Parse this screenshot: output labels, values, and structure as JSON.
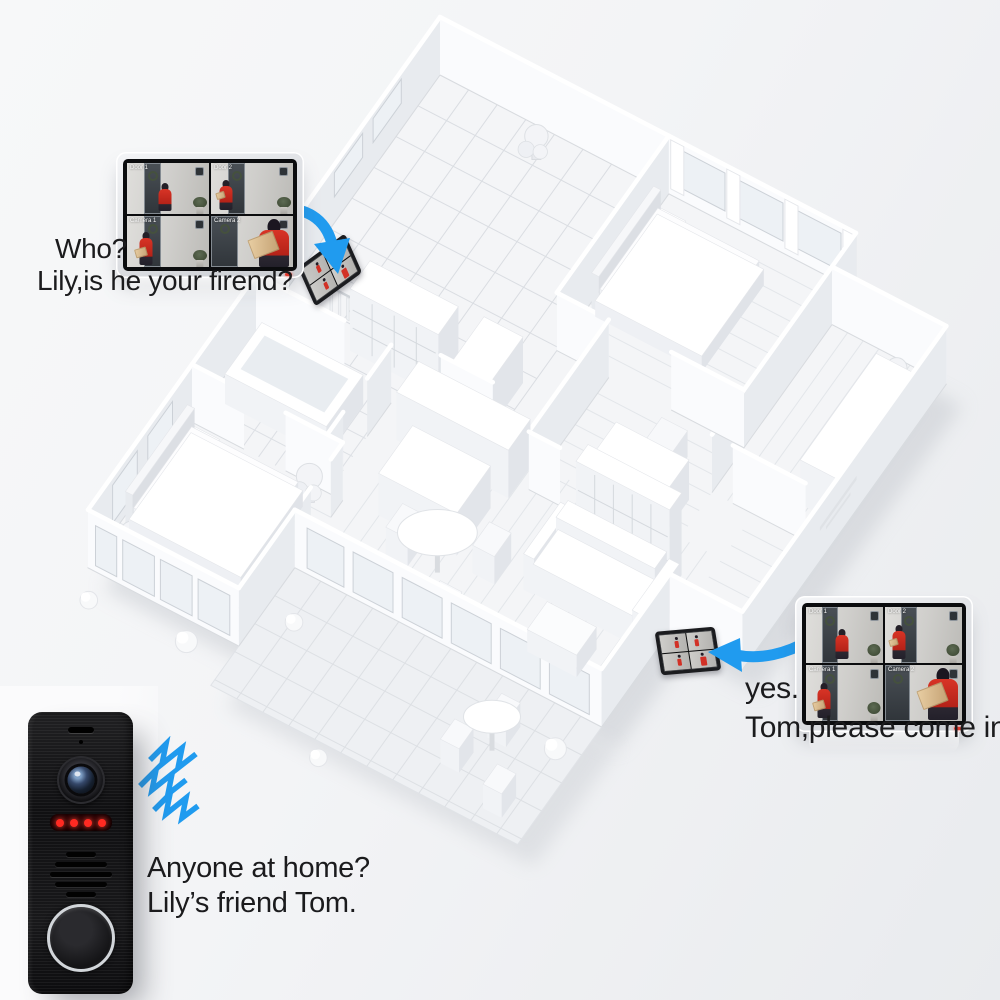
{
  "palette": {
    "accent_blue": "#209bef",
    "person_red": "#d23126",
    "led_red": "#ff2a22",
    "monitor_bezel": "#0b0c0e",
    "background": "#f3f4f6"
  },
  "icons": {
    "arrow_to_hall_monitor": "curved-blue-arrow",
    "arrow_to_entry_monitor": "curved-blue-arrow",
    "sound_waves": "blue-zigzag-waves"
  },
  "captions": {
    "visitor_question": {
      "line1": "Who?",
      "line2": "Lily,is he your firend?"
    },
    "owner_reply": {
      "line1": "yes.",
      "line2": "Tom,please come in."
    },
    "visitor_at_door": {
      "line1": "Anyone at home?",
      "line2": "Lily’s friend Tom."
    }
  },
  "monitor": {
    "feeds": [
      {
        "label": "Door 1"
      },
      {
        "label": "Door 2"
      },
      {
        "label": "Camera 1"
      },
      {
        "label": "Camera 2"
      }
    ]
  }
}
